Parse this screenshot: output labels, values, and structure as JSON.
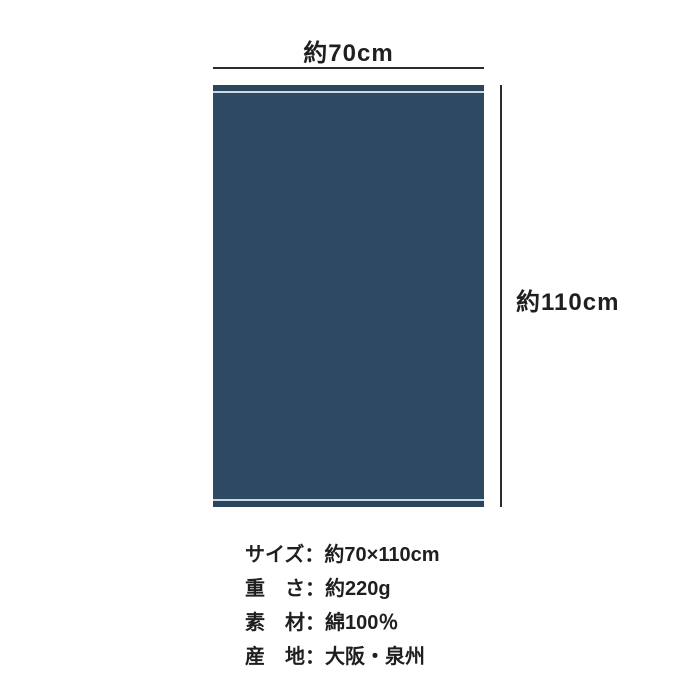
{
  "diagram": {
    "width_label": "約70cm",
    "height_label": "約110cm",
    "line_color": "#2b2b2b",
    "towel": {
      "body_color": "#2e4a63",
      "band_color": "#2b455c",
      "stitch_color": "#cbd9e4"
    }
  },
  "specs": [
    {
      "label": "サイズ",
      "separator": "：",
      "value": "約70×110cm"
    },
    {
      "label": "重　さ",
      "separator": "：",
      "value": "約220g"
    },
    {
      "label": "素　材",
      "separator": "：",
      "value": "綿100％"
    },
    {
      "label": "産　地",
      "separator": "：",
      "value": "大阪・泉州"
    }
  ]
}
